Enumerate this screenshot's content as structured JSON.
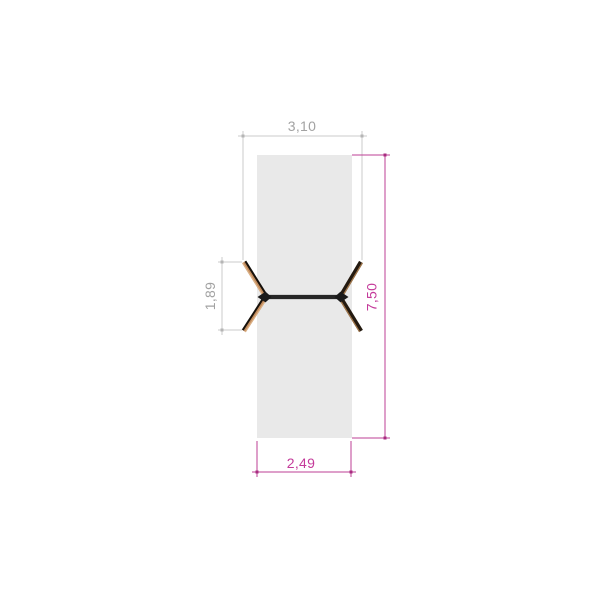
{
  "drawing": {
    "dims": {
      "top": "3,10",
      "right": "7,50",
      "left": "1,89",
      "bottom": "2,49"
    },
    "colors": {
      "background": "#ffffff",
      "panel_fill": "#e9e9e9",
      "dim_gray_line": "#cbcbcb",
      "dim_gray_marker": "#b5b5b5",
      "dim_gray_text": "#a2a2a2",
      "dim_magenta_line": "#bd3f95",
      "dim_magenta_marker": "#a82c80",
      "dim_magenta_text": "#c43a9a",
      "frame_dark": "#262626",
      "joint_black": "#1a1a1a",
      "leg_wood": "#c08a5c",
      "leg_wood_light": "#dcb287",
      "leg_dark": "#241a10",
      "leg_edge_dark": "#15100a",
      "leg_edge_tan": "#a0764a"
    }
  }
}
